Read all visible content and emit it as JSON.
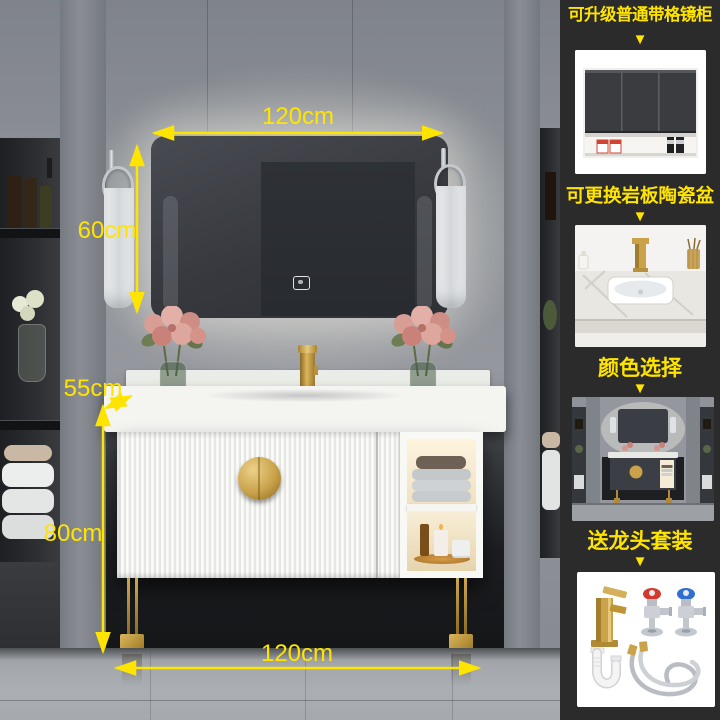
{
  "page": {
    "type": "bathroom-vanity-product-image"
  },
  "colors": {
    "accent_yellow": "#ffe400",
    "gold": "#c9a24a",
    "sidebar_bg": "#2b2b2b"
  },
  "annotations": {
    "mirror_width": "120cm",
    "mirror_height": "60cm",
    "counter_depth": "55cm",
    "cabinet_height": "80cm",
    "cabinet_width": "120cm"
  },
  "sidebar": {
    "arrow_glyph": "▼",
    "items": [
      {
        "label": "可升级普通带格镜柜",
        "image": "mirror-cabinet-option"
      },
      {
        "label": "可更换岩板陶瓷盆",
        "image": "slate-ceramic-basin-option"
      },
      {
        "label": "颜色选择",
        "image": "dark-color-vanity-option"
      },
      {
        "label": "送龙头套装",
        "image": "free-faucet-set-option"
      }
    ]
  }
}
